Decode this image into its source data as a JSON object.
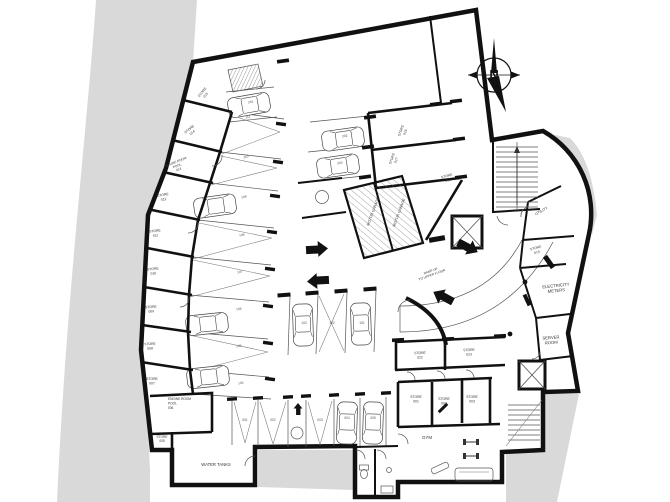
{
  "plan": {
    "type": "architectural basement parking floor plan",
    "compass": {
      "label": "N"
    },
    "colors": {
      "wall": "#111111",
      "site_fill": "#d9d9d9",
      "thin_line": "#555555",
      "text": "#333333"
    }
  },
  "rooms": {
    "store15": {
      "label": "STORE",
      "num": "015"
    },
    "store14": {
      "label": "STORE",
      "num": "014"
    },
    "engine13": {
      "l1": "ENGINE ROOM",
      "l2": "POOL",
      "num": "013"
    },
    "store12": {
      "label": "STORE",
      "num": "012"
    },
    "store11": {
      "label": "STORE",
      "num": "011"
    },
    "store10": {
      "label": "STORE",
      "num": "010"
    },
    "store09": {
      "label": "STORE",
      "num": "009"
    },
    "store08": {
      "label": "STORE",
      "num": "008"
    },
    "store07": {
      "label": "STORE",
      "num": "007"
    },
    "engine06": {
      "l1": "ENGINE ROOM",
      "l2": "POOL",
      "num": "006"
    },
    "store05": {
      "label": "STORE",
      "num": "005"
    },
    "store16": {
      "label": "STORE",
      "num": "016"
    },
    "store17": {
      "label": "STORE",
      "num": "017"
    },
    "store18": {
      "label": "STORE",
      "num": "018"
    },
    "utility": {
      "label": "UTILITY"
    },
    "store19": {
      "label": "STORE",
      "num": "019"
    },
    "electricity": {
      "l1": "ELECTRICITY",
      "l2": "METERS"
    },
    "server": {
      "l1": "SERVER",
      "l2": "ROOM"
    },
    "store22": {
      "label": "STORE",
      "num": "022"
    },
    "store23": {
      "label": "STORE",
      "num": "023"
    },
    "store01": {
      "label": "STORE",
      "num": "001"
    },
    "store02": {
      "label": "STORE",
      "num": "002"
    },
    "store03": {
      "label": "STORE",
      "num": "003"
    },
    "motor_garage_a": {
      "label": "MOTOR GARAGE"
    },
    "motor_garage_b": {
      "label": "MOTOR GARAGE"
    },
    "ramp": {
      "l1": "RAMP UP",
      "l2": "TO UPPER FLOOR"
    },
    "gym": {
      "label": "GYM"
    },
    "water_tanks": {
      "label": "WATER TANKS"
    }
  },
  "parking": {
    "left": [
      "111",
      "110",
      "109",
      "108",
      "107",
      "106",
      "105",
      "104"
    ],
    "top": [
      "201",
      "202",
      "203"
    ],
    "center": [
      "103",
      "102",
      "101"
    ],
    "bottom": [
      "001",
      "002",
      "003",
      "004",
      "005"
    ]
  }
}
